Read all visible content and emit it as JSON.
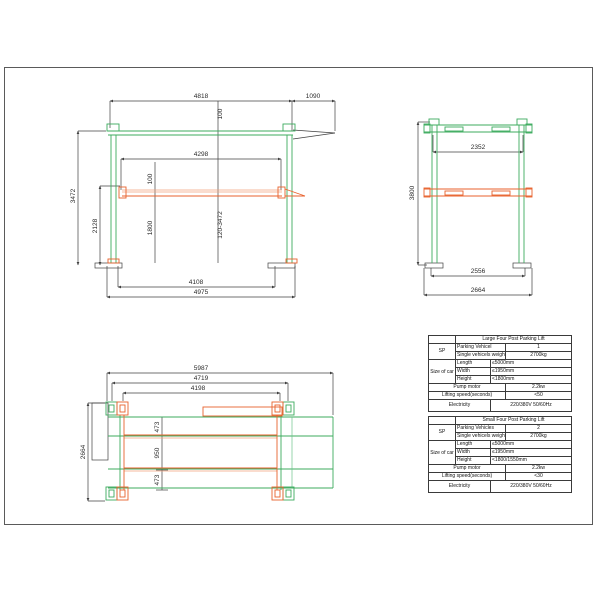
{
  "views": {
    "front": {
      "dim_4818": "4818",
      "dim_1090": "1090",
      "dim_100_top": "100",
      "dim_4298": "4298",
      "dim_3472": "3472",
      "dim_2128": "2128",
      "dim_100_mid": "100",
      "dim_1800": "1800",
      "dim_travel": "120-3472",
      "dim_4108": "4108",
      "dim_4975": "4975"
    },
    "side": {
      "dim_2352": "2352",
      "dim_3800": "3800",
      "dim_2556": "2556",
      "dim_2664": "2664"
    },
    "top": {
      "dim_5987": "5987",
      "dim_4719": "4719",
      "dim_4198": "4198",
      "dim_2664": "2664",
      "dim_473_top": "473",
      "dim_950": "950",
      "dim_473_bottom": "473"
    }
  },
  "colors": {
    "post_green": "#3cab5e",
    "platform_orange": "#e8622d",
    "platform_orange_light": "#f2a37e",
    "line_black": "#404040"
  },
  "tables": {
    "large": {
      "title": "Large Four Post Parking Lift",
      "sp_label": "SP",
      "parking_label": "Parking Vehicel",
      "parking_value": "1",
      "weight_label": "Single vehicels weight(kg)",
      "weight_value": "2700kg",
      "size_label": "Size of car",
      "length_label": "Length",
      "length_value": "≤5000mm",
      "width_label": "Width",
      "width_value": "≤1950mm",
      "height_label": "Height",
      "height_value": "<1800mm",
      "pump_label": "Pump motor",
      "pump_value": "2.2kw",
      "lifting_label": "Lifting speed(seconds)",
      "lifting_value": "<50",
      "electricity_label": "Electricity",
      "electricity_value": "220/380V 50/60Hz"
    },
    "small": {
      "title": "Small Four Post Parking Lift",
      "sp_label": "SP",
      "parking_label": "Parking Vehicles",
      "parking_value": "2",
      "weight_label": "Single vehicels weight(kg)",
      "weight_value": "2700kg",
      "size_label": "Size of car",
      "length_label": "Length",
      "length_value": "≤5000mm",
      "width_label": "Width",
      "width_value": "≤1950mm",
      "height_label": "Height",
      "height_value": "<1800/1550mm",
      "pump_label": "Pump motor",
      "pump_value": "2.2kw",
      "lifting_label": "Lifting speed(seconds)",
      "lifting_value": "<30",
      "electricity_label": "Electricity",
      "electricity_value": "220/380V 50/60Hz"
    }
  }
}
